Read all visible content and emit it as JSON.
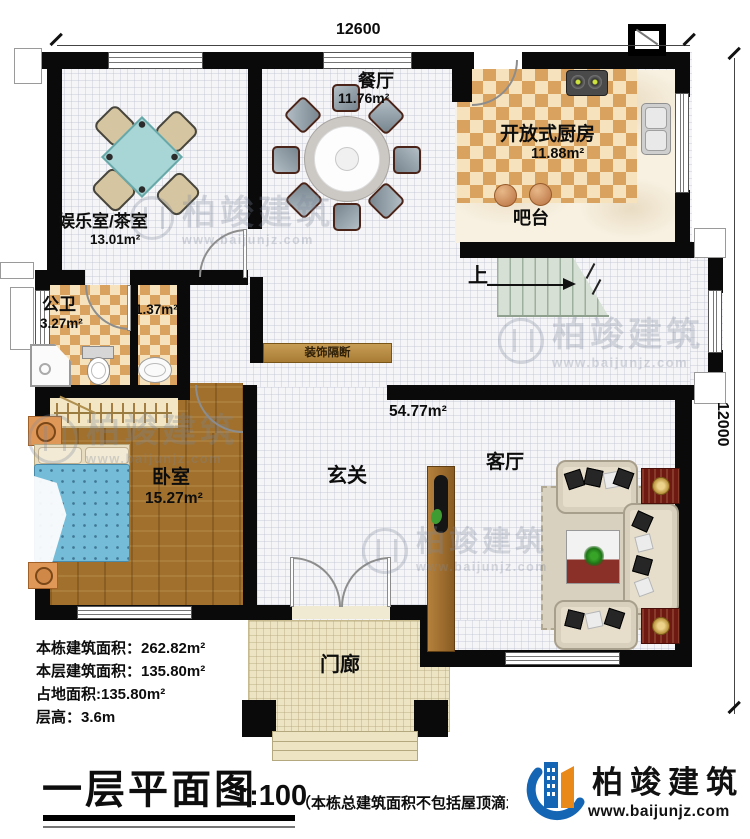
{
  "document": {
    "type_label": "一层平面图",
    "scale": "1:100",
    "note": "（本栋总建筑面积不包括屋顶滴水面积：15.6㎡）"
  },
  "dimensions": {
    "top": "12600",
    "right": "12000"
  },
  "rooms": {
    "tea_room": {
      "name": "娱乐室/茶室",
      "area": "13.01m²"
    },
    "dining": {
      "name": "餐厅",
      "area": "11.76m²"
    },
    "kitchen": {
      "name": "开放式厨房",
      "area": "11.88m²"
    },
    "bar": {
      "name": "吧台"
    },
    "bathroom": {
      "name": "公卫",
      "area": "3.27m²"
    },
    "bath_niche": {
      "area": "1.37m²"
    },
    "bedroom": {
      "name": "卧室",
      "area": "15.27m²"
    },
    "hall": {
      "name": "玄关"
    },
    "living": {
      "name": "客厅"
    },
    "porch": {
      "name": "门廊"
    },
    "open_area": {
      "area": "54.77m²"
    },
    "partition": {
      "name": "装饰隔断"
    },
    "stairs": {
      "direction_label": "上"
    }
  },
  "info": {
    "l1": "本栋建筑面积：262.82m²",
    "l2": "本层建筑面积：135.80m²",
    "l3": "占地面积:135.80m²",
    "l4": "层高：3.6m"
  },
  "brand": {
    "name": "柏竣建筑",
    "site": "www.baijunjz.com"
  },
  "watermark": {
    "name": "柏竣建筑",
    "site": "www.baijunjz.com"
  },
  "colors": {
    "wall": "#0a0a0a",
    "kitchen_tile_dark": "#d9a35f",
    "kitchen_tile_light": "#f6e3bd",
    "wood_floor": "#a0702c",
    "stair": "#d6e0d5",
    "porch": "#ece4c3",
    "bed_quilt": "#74bcd8",
    "tea_table": "#a8d6d6",
    "partition_bar": "#c0914a",
    "brand_blue": "#1565b5",
    "brand_orange": "#e8891a"
  }
}
